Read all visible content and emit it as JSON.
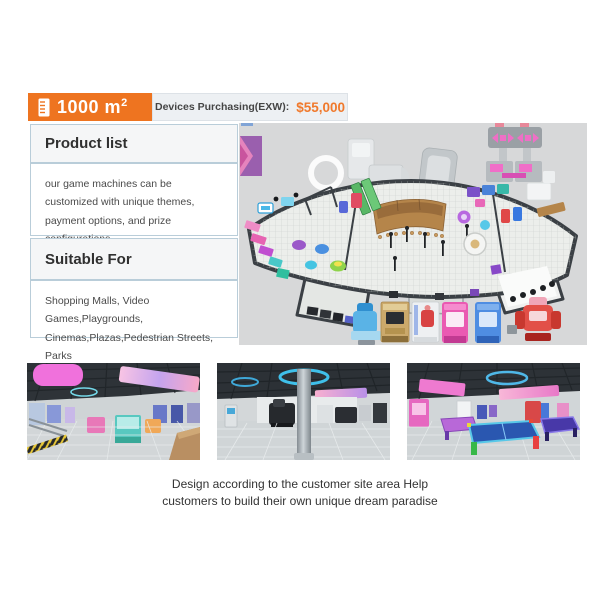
{
  "colors": {
    "accent_orange": "#ee7420",
    "price_orange": "#f0792c",
    "panel_border": "#b9cdd9",
    "floorplan_background": "#d7d8d9"
  },
  "header": {
    "area_value": "1000 m",
    "area_exp": "2",
    "devices_label": "Devices Purchasing(EXW):",
    "devices_price": "$55,000"
  },
  "icons": {
    "area_badge_icon": "ruler-icon"
  },
  "panels": {
    "product": {
      "title": "Product list",
      "body": "our game machines can be customized with unique themes, payment options, and prize configurations."
    },
    "suitable": {
      "title": "Suitable For",
      "body": "Shopping Malls, Video Games,Playgrounds, Cinemas,Plazas,Pedestrian Streets, Parks"
    }
  },
  "caption": {
    "line1": "Design according to the customer site area Help",
    "line2": "customers to build their own unique dream paradise"
  }
}
